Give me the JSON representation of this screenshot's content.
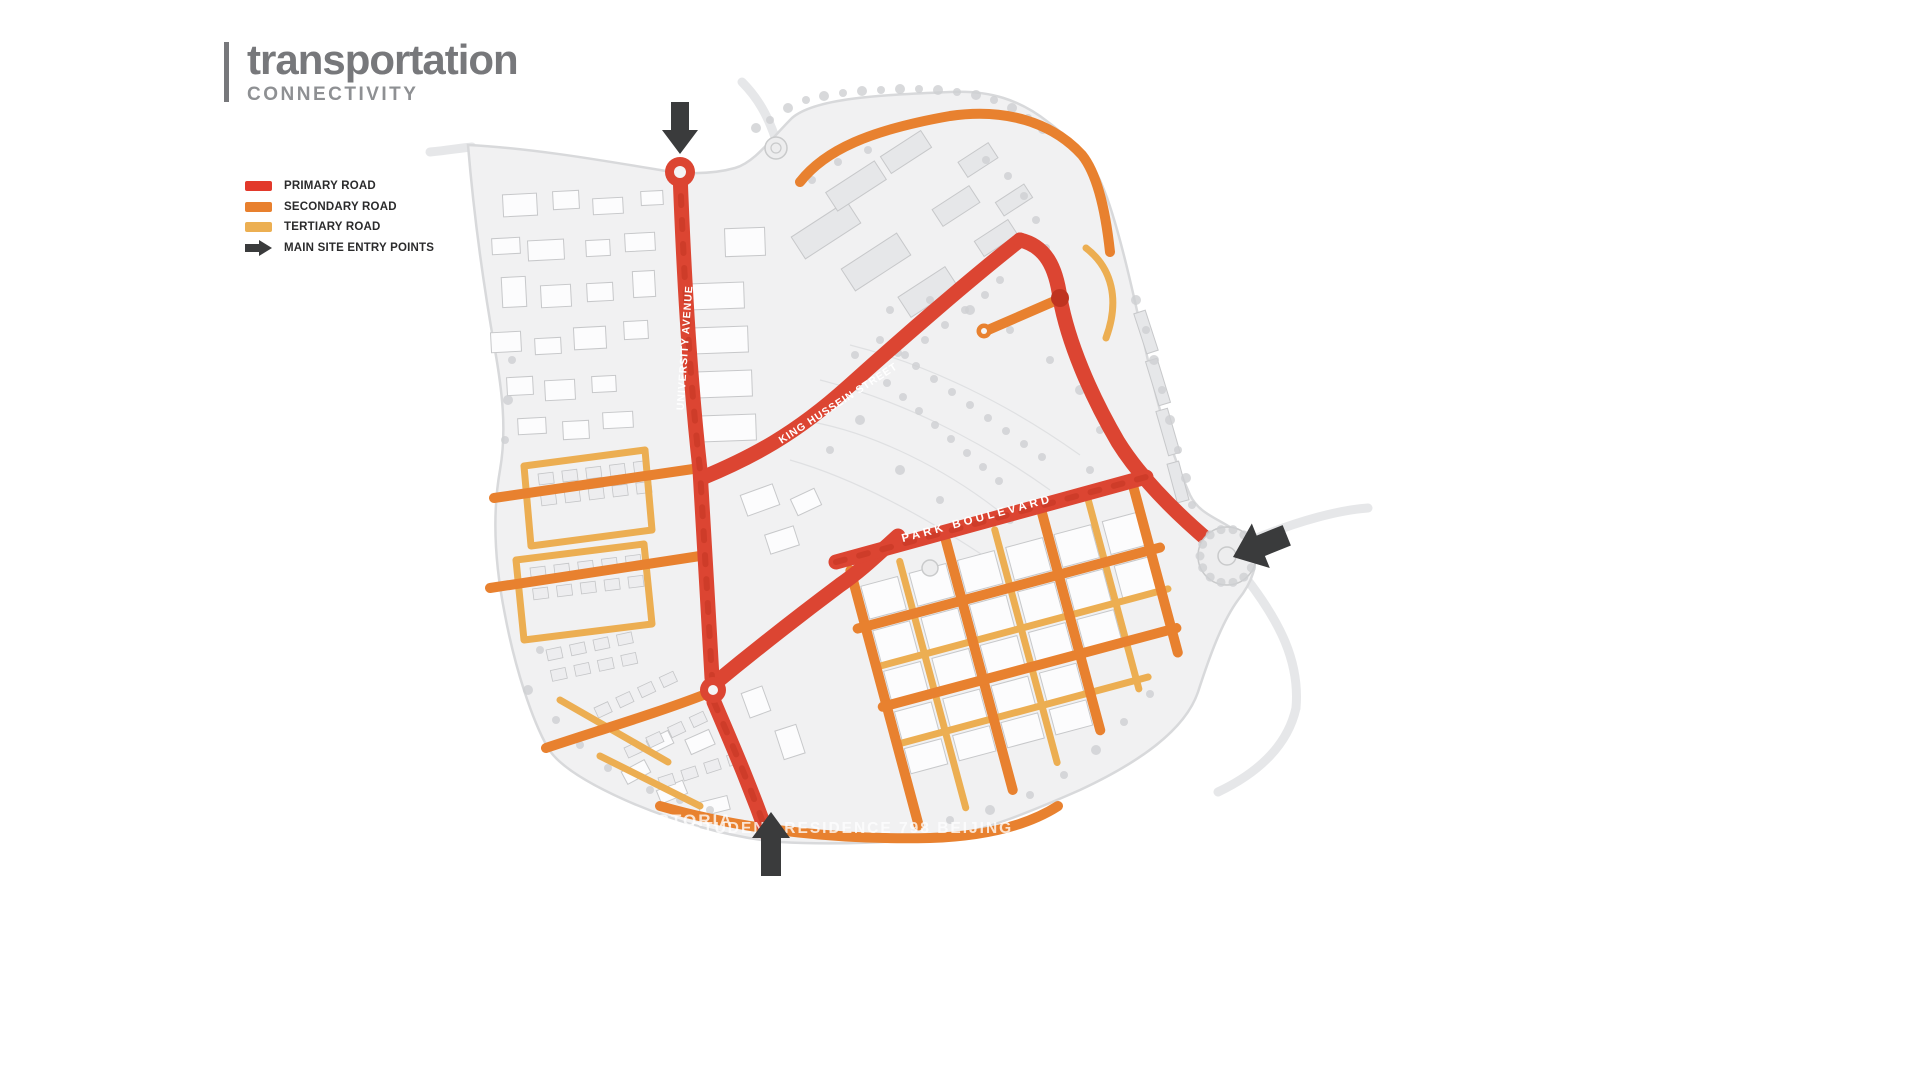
{
  "header": {
    "title": "transportation",
    "subtitle": "CONNECTIVITY"
  },
  "legend": {
    "items": [
      {
        "label": "PRIMARY ROAD",
        "color": "#e2392b",
        "icon": "swatch"
      },
      {
        "label": "SECONDARY ROAD",
        "color": "#e8802e",
        "icon": "swatch"
      },
      {
        "label": "TERTIARY ROAD",
        "color": "#ecaf52",
        "icon": "swatch"
      },
      {
        "label": "MAIN SITE ENTRY POINTS",
        "color": "#3a3b3c",
        "icon": "arrow"
      }
    ]
  },
  "map": {
    "road_labels": {
      "university_avenue": "UNIVERSITY AVENUE",
      "king_hussein_street": "KING HUSSEIN STREET",
      "park_boulevard": "PARK BOULEVARD"
    },
    "entry_points": {
      "count": 3,
      "positions": [
        "north",
        "east",
        "south"
      ]
    },
    "watermarks": {
      "left": "CAMPUS IN VICTORIA",
      "right": "STUDENT RESIDENCE 798 BEIJING"
    }
  },
  "colors": {
    "primary-road": "#dc4532",
    "primary-road-dark": "#bf3420",
    "secondary-road": "#e8812f",
    "tertiary-road": "#ecae52",
    "entry-arrow": "#3a3b3c",
    "title-gray": "#77787b",
    "subtitle-gray": "#8e9093"
  }
}
